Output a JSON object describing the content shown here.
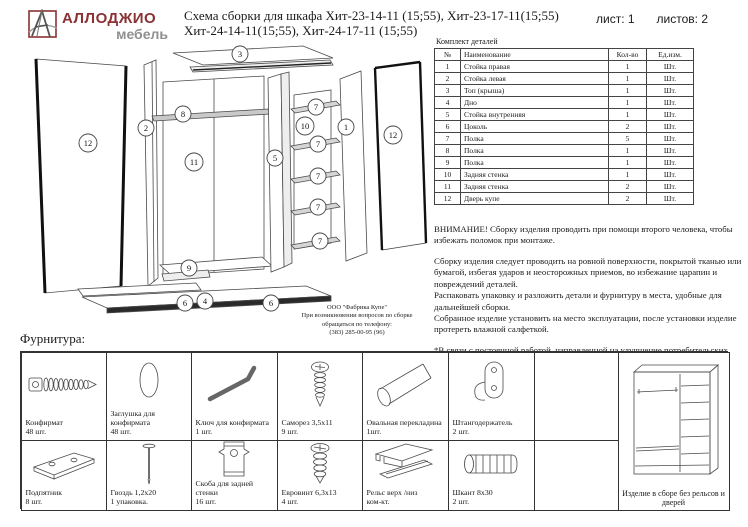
{
  "header": {
    "brand_name": "АЛЛОДЖИО",
    "brand_sub": "мебель",
    "title_line1": "Схема сборки для шкафа Хит-23-14-11 (15;55), Хит-23-17-11(15;55)",
    "title_line2": "Хит-24-14-11(15;55), Хит-24-17-11 (15;55)",
    "sheet_label": "лист: 1",
    "sheets_label": "листов: 2"
  },
  "parts_table": {
    "title": "Комплект деталей",
    "columns": [
      "№",
      "Наименование",
      "Кол-во",
      "Ед.изм."
    ],
    "rows": [
      {
        "n": "1",
        "name": "Стойка правая",
        "qty": "1",
        "unit": "Шт."
      },
      {
        "n": "2",
        "name": "Стойка левая",
        "qty": "1",
        "unit": "Шт."
      },
      {
        "n": "3",
        "name": "Топ (крыша)",
        "qty": "1",
        "unit": "Шт."
      },
      {
        "n": "4",
        "name": "Дно",
        "qty": "1",
        "unit": "Шт."
      },
      {
        "n": "5",
        "name": "Стойка внутренняя",
        "qty": "1",
        "unit": "Шт."
      },
      {
        "n": "6",
        "name": "Цоколь",
        "qty": "2",
        "unit": "Шт."
      },
      {
        "n": "7",
        "name": "Полка",
        "qty": "5",
        "unit": "Шт."
      },
      {
        "n": "8",
        "name": "Полка",
        "qty": "1",
        "unit": "Шт."
      },
      {
        "n": "9",
        "name": "Полка",
        "qty": "1",
        "unit": "Шт."
      },
      {
        "n": "10",
        "name": "Задняя стенка",
        "qty": "1",
        "unit": "Шт."
      },
      {
        "n": "11",
        "name": "Задняя стенка",
        "qty": "2",
        "unit": "Шт."
      },
      {
        "n": "12",
        "name": "Дверь купе",
        "qty": "2",
        "unit": "Шт."
      }
    ]
  },
  "notes": {
    "warning": "ВНИМАНИЕ! Сборку изделия проводить при помощи второго человека, чтобы избежать поломок при монтаже.",
    "p1": "Сборку изделия следует проводить на ровной поверхности, покрытой тканью или бумагой, избегая ударов и неосторожных приемов, во избежание царапин и повреждений деталей.",
    "p2": "Распаковать упаковку и разложить детали и фурнитуру в места, удобные для дальнейшей сборки.",
    "p3": "Собранное изделие установить на место эксплуатации, после установки изделие протереть влажной салфеткой.",
    "p4": "*В связи с постоянной работой, направленной на улучшение потребительских свойств мебели, возможны незначительные изменения в конструкции не влияющие на функциональные качества изделий."
  },
  "diagram": {
    "callouts": [
      "3",
      "8",
      "2",
      "12",
      "11",
      "5",
      "7",
      "10",
      "1",
      "12",
      "7",
      "7",
      "7",
      "7",
      "9",
      "6",
      "4",
      "6"
    ],
    "factory": {
      "line1": "ООО \"Фабрика Купе\"",
      "line2": "При возникновении вопросов по сборке",
      "line3": "обращаться по телефону:",
      "line4": "(383) 285-00-95 (96)"
    }
  },
  "hardware": {
    "title": "Фурнитура:",
    "row1": [
      {
        "name": "Конфирмат",
        "qty": "48 шт.",
        "icon": "confirmat-screw"
      },
      {
        "name": "Заглушка для конфирмата",
        "qty": "48 шт.",
        "icon": "screw-cap"
      },
      {
        "name": "Ключ для конфирмата",
        "qty": "1 шт.",
        "icon": "hex-key"
      },
      {
        "name": "Саморез 3,5х11",
        "qty": "9 шт.",
        "icon": "self-tapping-screw"
      },
      {
        "name": "Овальная перекладина",
        "qty": "1шт.",
        "icon": "oval-rod"
      },
      {
        "name": "Штангодержатель",
        "qty": "2 шт.",
        "icon": "rod-holder"
      }
    ],
    "row2": [
      {
        "name": "Подпятник",
        "qty": "8 шт.",
        "icon": "foot-plate"
      },
      {
        "name": "Гвоздь 1,2х20",
        "qty": "1 упаковка.",
        "icon": "nail"
      },
      {
        "name": "Скоба для задней стенки",
        "qty": "16 шт.",
        "icon": "back-panel-clip"
      },
      {
        "name": "Евровинт 6,3х13",
        "qty": "4 шт.",
        "icon": "euro-screw"
      },
      {
        "name": "Рельс верх /низ",
        "qty": "ком-кт.",
        "icon": "rail"
      },
      {
        "name": "Шкант 8х30",
        "qty": "2 шт.",
        "icon": "dowel"
      }
    ],
    "assembled_caption": "Изделие в сборе без рельсов и дверей"
  }
}
